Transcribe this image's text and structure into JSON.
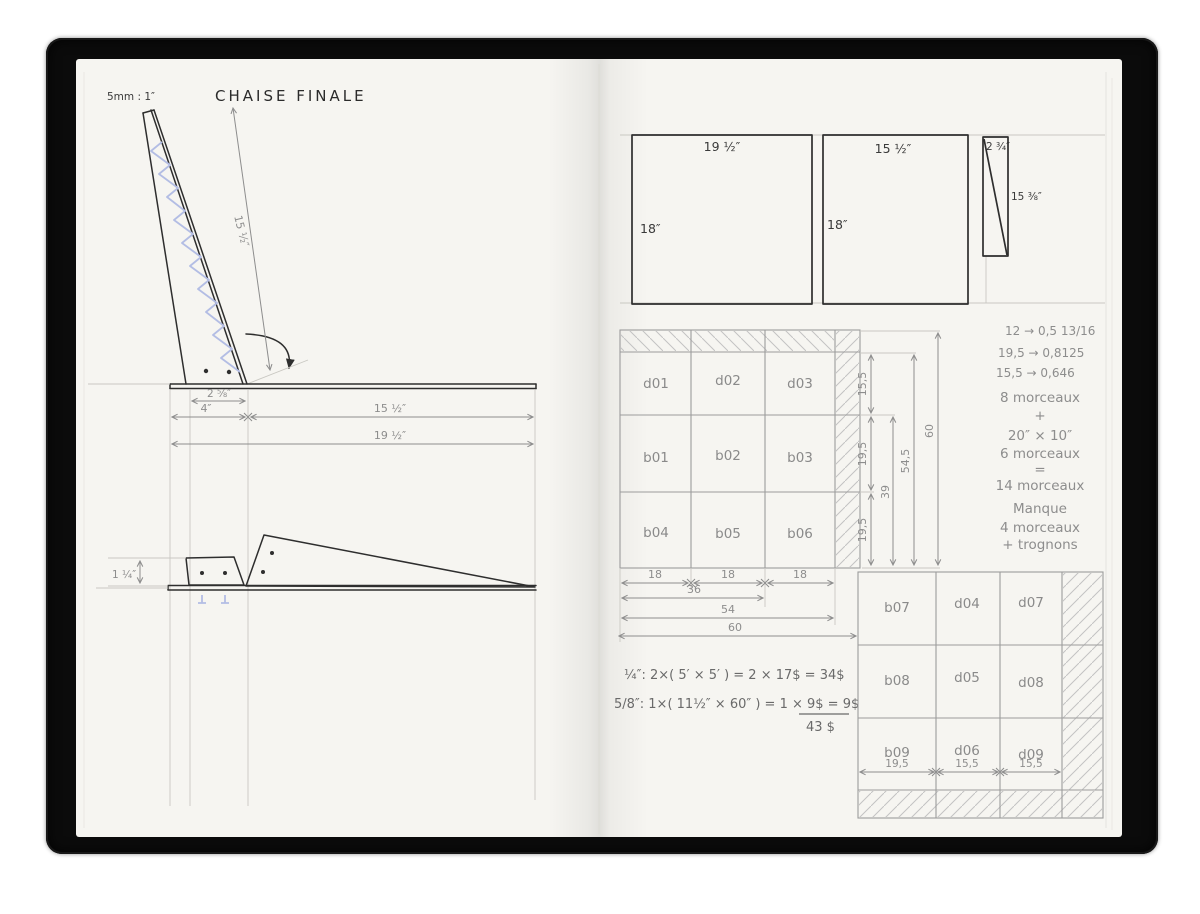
{
  "colors": {
    "paper": "#f6f5f1",
    "cover_black": "#0b0b0b",
    "ink": "#2e2e2e",
    "pencil": "#8d8d8d",
    "hatch_blue": "#b3bde4"
  },
  "left": {
    "scale": "5mm : 1″",
    "title": "CHAISE FINALE",
    "back_dim": "15 ½″",
    "dim_cleat": "2 ⅝″",
    "dim_front": "4″",
    "dim_seat": "15 ½″",
    "dim_total": "19 ½″",
    "dim_thickness": "1 ¼″"
  },
  "panels": {
    "p1w": "19 ½″",
    "p1h": "18″",
    "p2w": "15 ½″",
    "p2h": "18″",
    "p3w": "2 ¾″",
    "p3h": "15 ⅜″"
  },
  "conversions": [
    "12 → 0,5  13/16",
    "19,5 → 0,8125",
    "15,5 → 0,646"
  ],
  "grid_top": {
    "cells": [
      "d01",
      "d02",
      "d03",
      "b01",
      "b02",
      "b03",
      "b04",
      "b05",
      "b06"
    ],
    "w1": "18",
    "w2": "18",
    "w3": "18",
    "w36": "36",
    "w54": "54",
    "w60": "60",
    "v1": "15,5",
    "v2": "19,5",
    "v3": "19,5",
    "v39": "39",
    "v545": "54,5",
    "v60": "60"
  },
  "notes": [
    "8 morceaux",
    "+",
    "20″ × 10″",
    "6 morceaux",
    "=",
    "14 morceaux",
    "Manque",
    "4 morceaux",
    "+ trognons"
  ],
  "costs": {
    "l1": "¼″: 2×( 5′ × 5′ ) = 2 × 17$ = 34$",
    "l2": "5/8″: 1×( 11½″ × 60″ ) = 1 × 9$ = 9$",
    "total": "43 $"
  },
  "grid_bottom": {
    "cells": [
      "b07",
      "d04",
      "d07",
      "b08",
      "d05",
      "d08",
      "b09",
      "d06",
      "d09"
    ],
    "d1": "19,5",
    "d2": "15,5",
    "d3": "15,5"
  }
}
